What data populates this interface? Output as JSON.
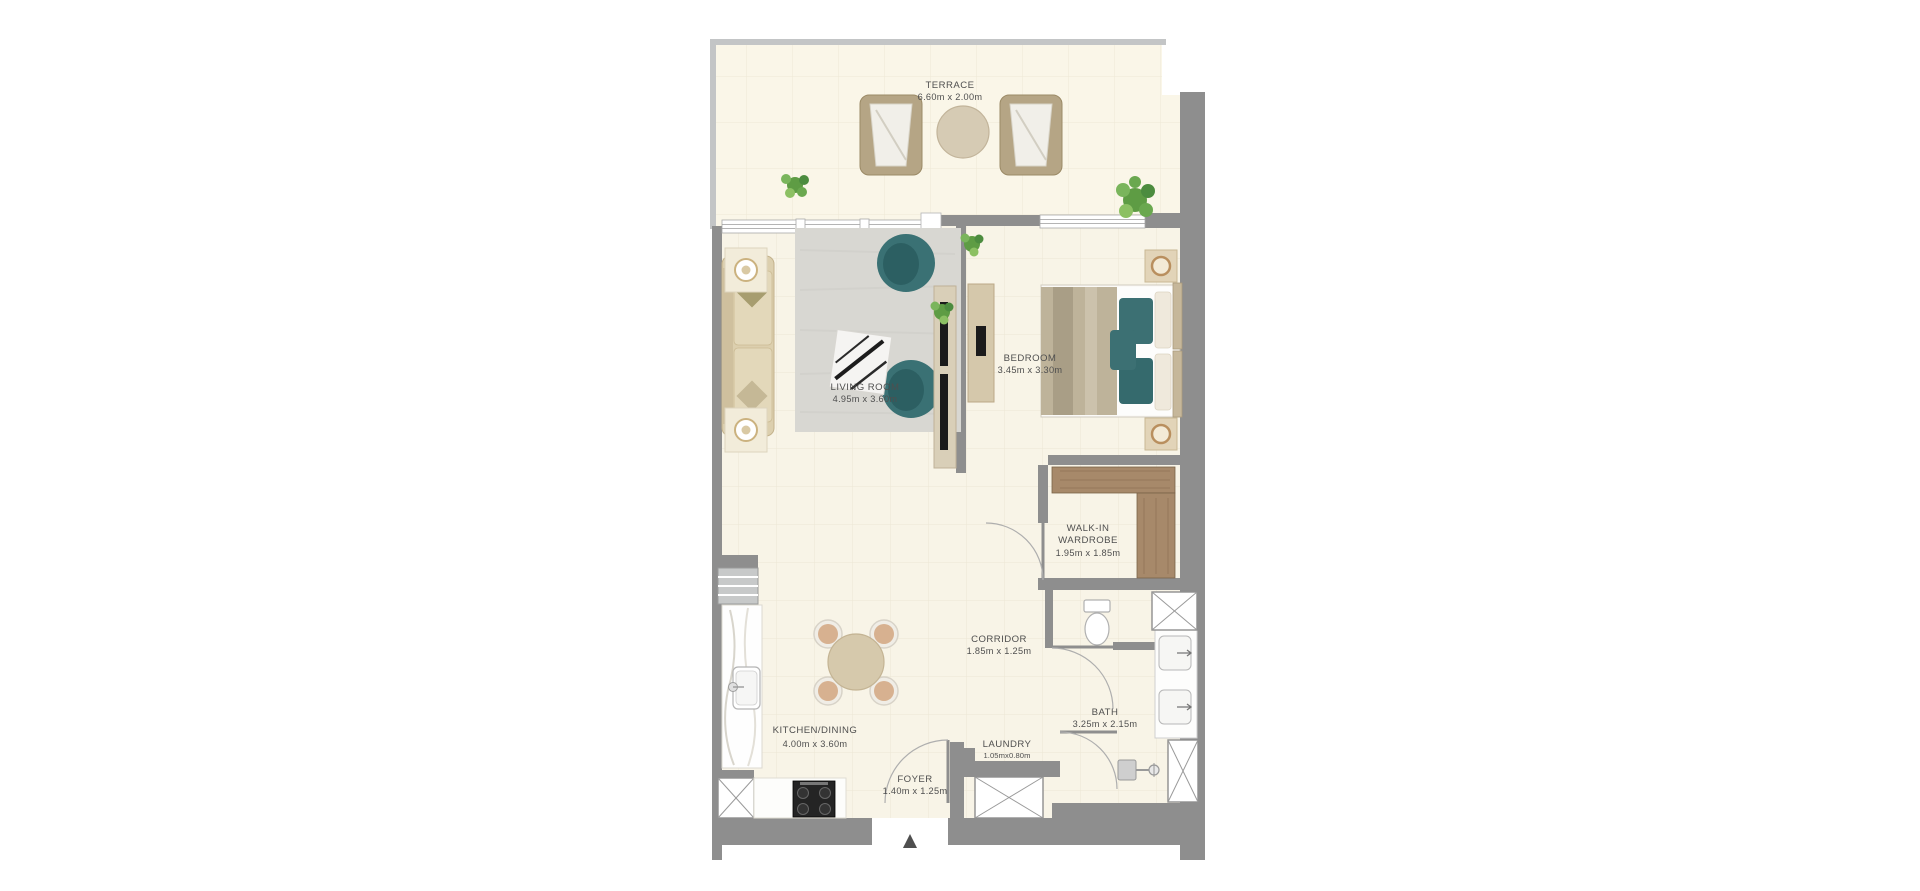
{
  "canvas": {
    "width": 1920,
    "height": 891,
    "background": "#ffffff"
  },
  "plan": {
    "name": "one-bedroom-apartment-floor-plan",
    "entrance_marker": "▲",
    "colors": {
      "wall_dark": "#8e8e8e",
      "wall_light": "#c3c5c6",
      "interior_floor": "#f8f4e7",
      "terrace_floor": "#faf6e8",
      "rug": "#d8d7d2",
      "accent_teal": "#3a7174",
      "wardrobe_brown": "#a7896a",
      "furniture_beige": "#dccfae",
      "label_text": "#4f4f4f"
    },
    "rooms": [
      {
        "name": "TERRACE",
        "dims": "6.60m x 2.00m"
      },
      {
        "name": "LIVING ROOM",
        "dims": "4.95m x 3.60m"
      },
      {
        "name": "BEDROOM",
        "dims": "3.45m x 3.30m"
      },
      {
        "name": "WALK-IN",
        "name2": "WARDROBE",
        "dims": "1.95m x 1.85m"
      },
      {
        "name": "CORRIDOR",
        "dims": "1.85m x 1.25m"
      },
      {
        "name": "BATH",
        "dims": "3.25m x 2.15m"
      },
      {
        "name": "LAUNDRY",
        "dims": "1.05mx0.80m"
      },
      {
        "name": "KITCHEN/DINING",
        "dims": "4.00m x 3.60m"
      },
      {
        "name": "FOYER",
        "dims": "1.40m x 1.25m"
      }
    ]
  }
}
